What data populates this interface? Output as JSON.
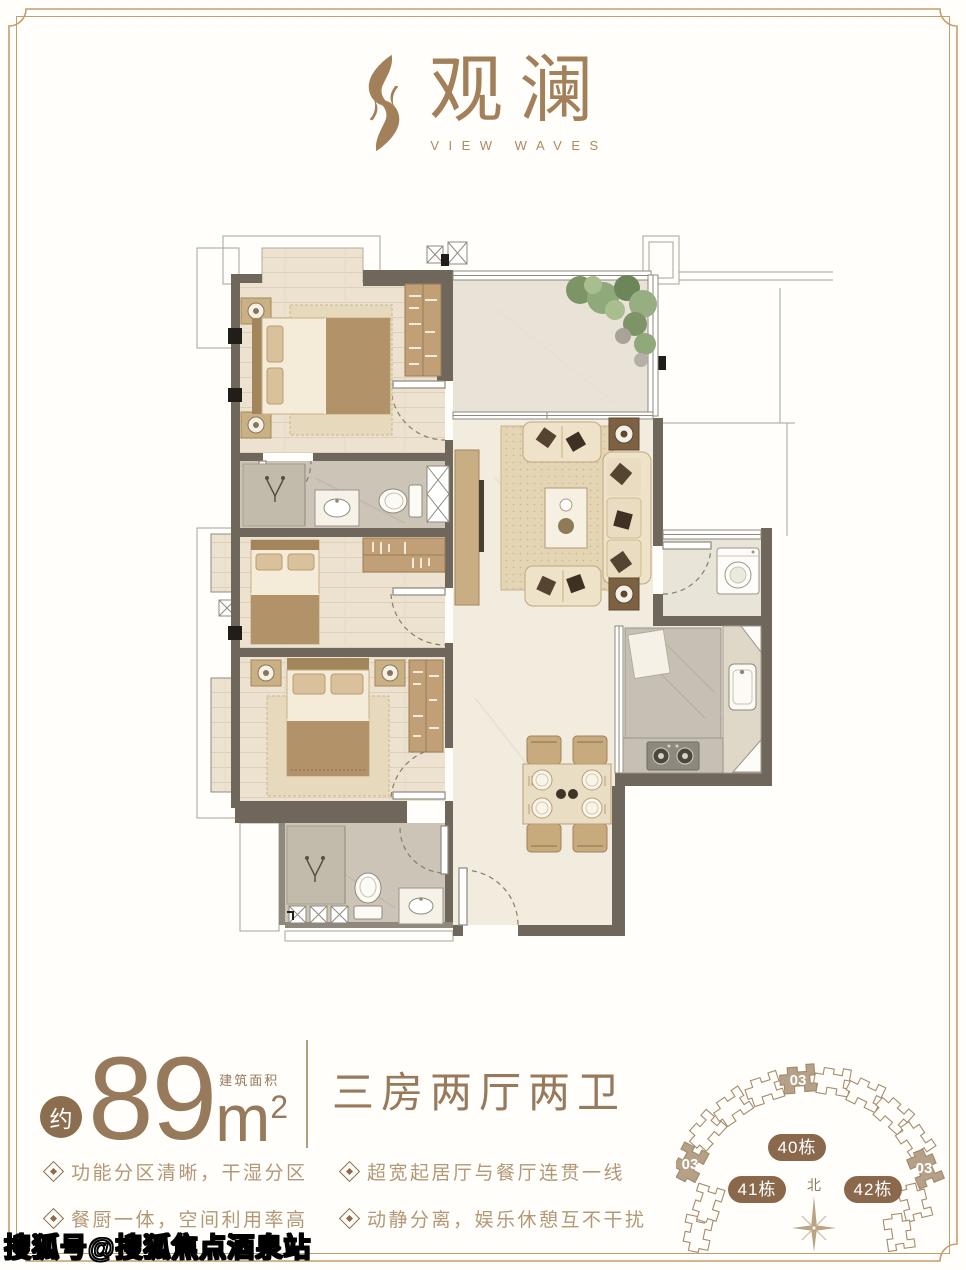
{
  "logo": {
    "name_cn": "观澜",
    "name_en": "VIEW WAVES"
  },
  "area": {
    "prefix": "约",
    "value": "89",
    "unit_base": "m",
    "unit_exp": "2",
    "area_type_label": "建筑面积",
    "layout_name": "三房两厅两卫"
  },
  "features": [
    {
      "text": "功能分区清晰，干湿分区"
    },
    {
      "text": "餐厨一体，空间利用率高"
    },
    {
      "text": "超宽起居厅与餐厅连贯一线"
    },
    {
      "text": "动静分离，娱乐休憩互不干扰"
    }
  ],
  "site_map": {
    "building_badges": [
      "40栋",
      "41栋",
      "42栋"
    ],
    "unit_label": "03",
    "north_label": "北"
  },
  "watermark": "搜狐号@搜狐焦点酒泉站",
  "colors": {
    "brand_brown": "#a2805a",
    "area_text": "#97795b",
    "feature_text": "#b29877",
    "frame": "#c49e70",
    "badge_fill": "#8a684c",
    "building_highlight": "#b4a188",
    "wall": "#6f675c"
  }
}
